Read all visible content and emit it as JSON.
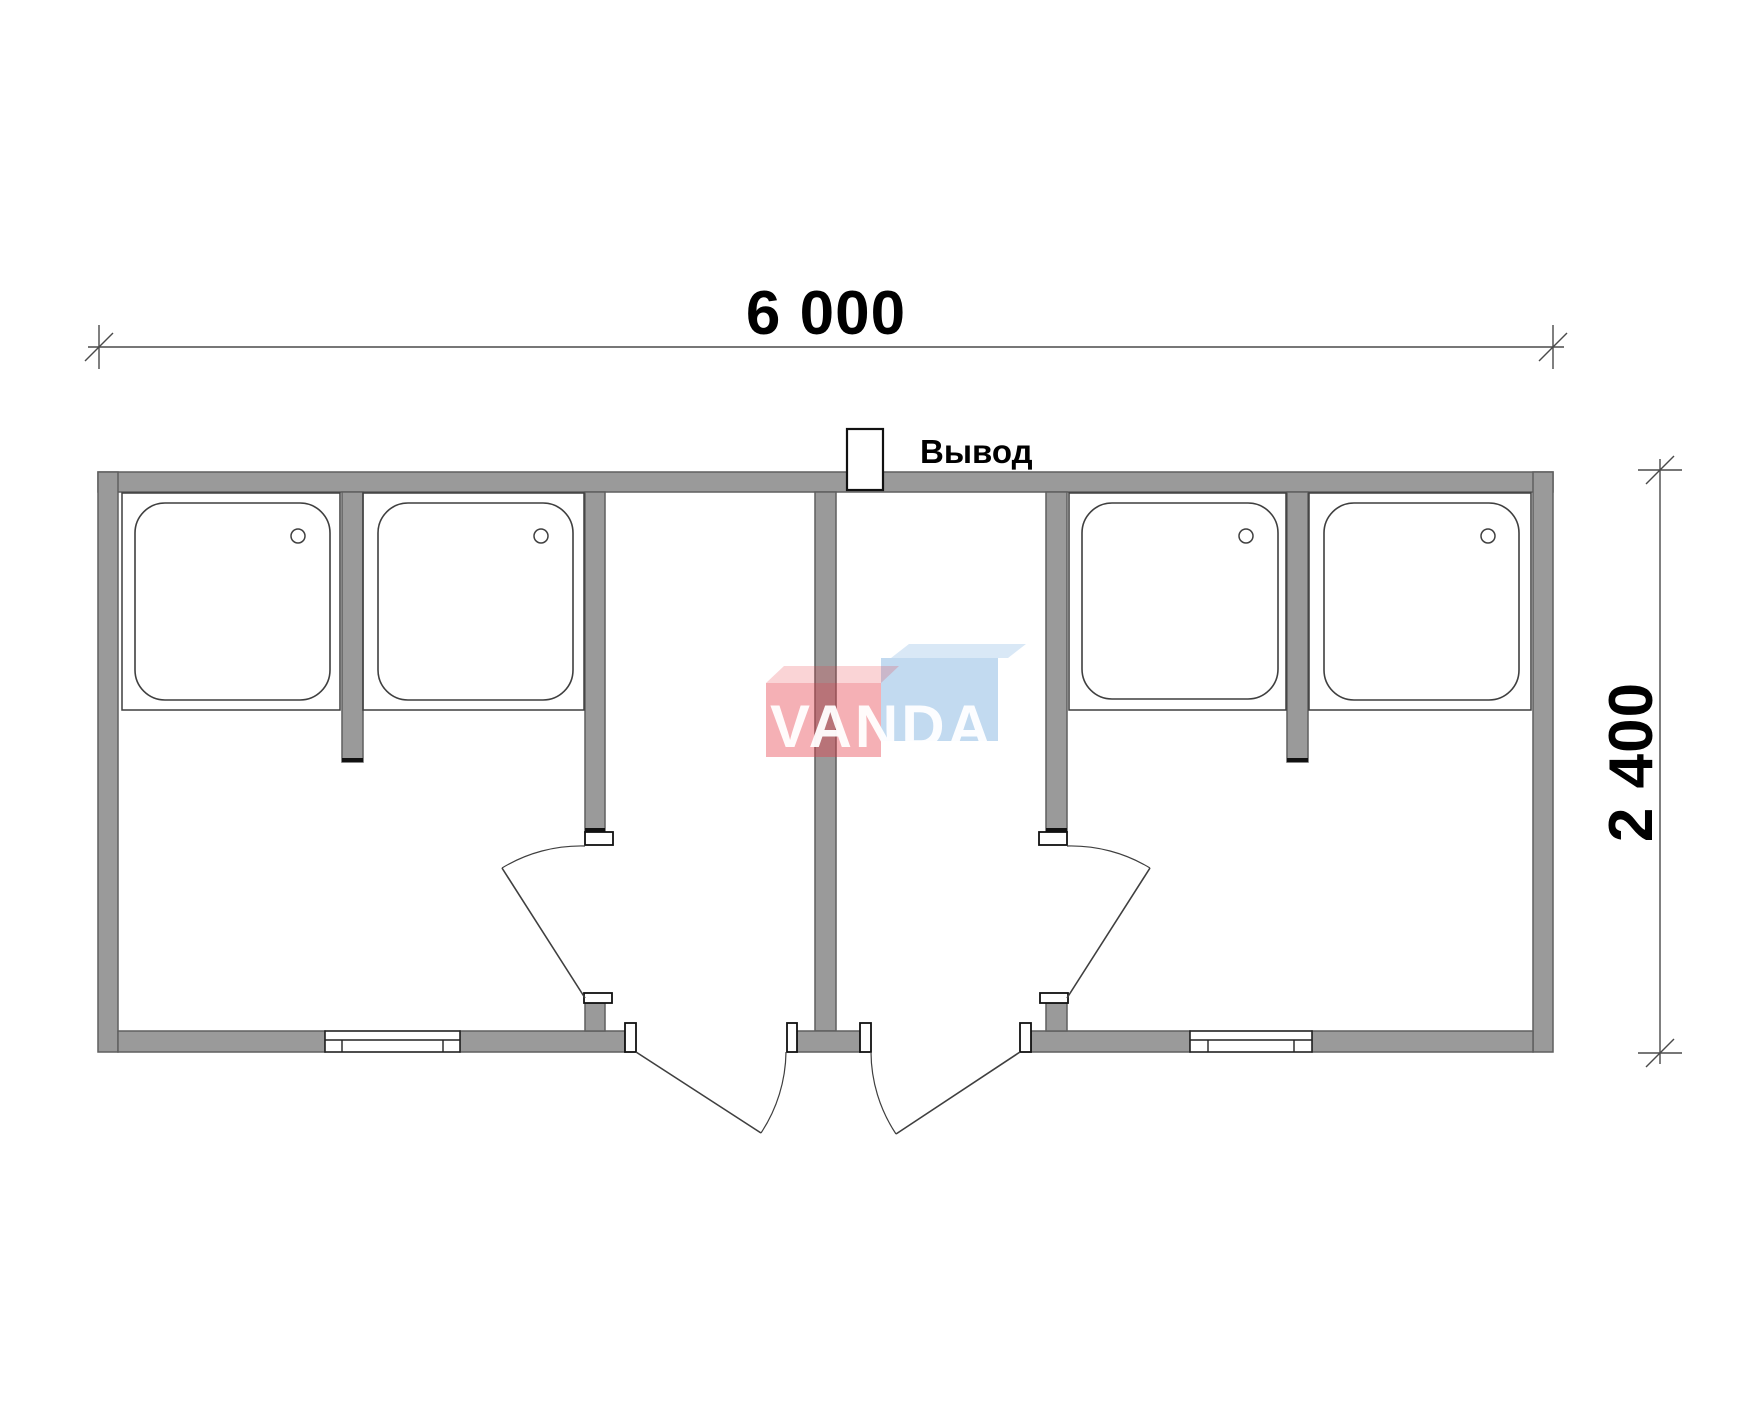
{
  "dimensions": {
    "top": {
      "label": "6 000"
    },
    "right": {
      "label": "2 400"
    }
  },
  "annotations": {
    "outlet_label": "Вывод"
  },
  "watermark": {
    "text": "VANDA"
  },
  "colors": {
    "wall_fill": "#9a9a9a",
    "wall_stroke": "#5f5f5f",
    "line": "#3f3f3f",
    "dim": "#4a4a4a",
    "logo_red": "#e63946",
    "logo_blue": "#5f9fd8",
    "bg": "#ffffff"
  }
}
